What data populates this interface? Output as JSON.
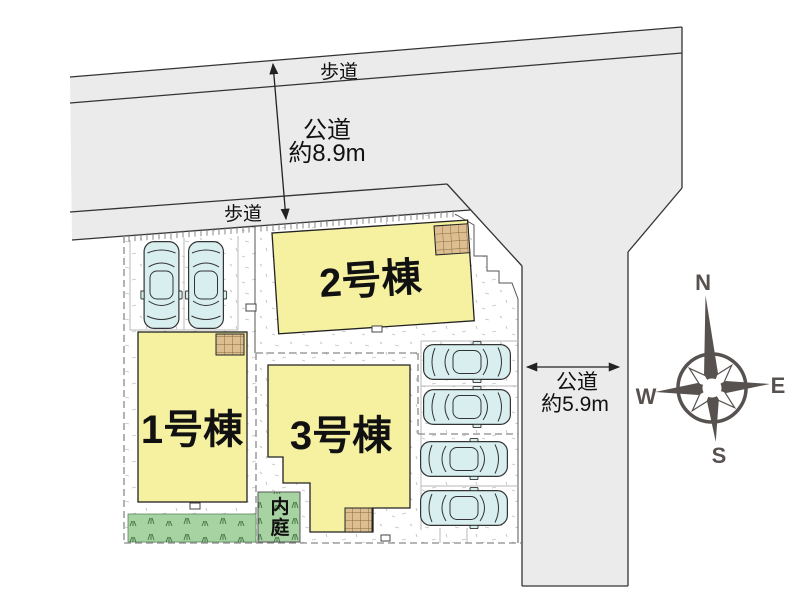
{
  "roads": {
    "top_road": {
      "sidewalk_top_label": "歩道",
      "sidewalk_bottom_label": "歩道",
      "type_label": "公道",
      "width_label": "約8.9m"
    },
    "right_road": {
      "type_label": "公道",
      "width_label": "約5.9m"
    }
  },
  "buildings": [
    {
      "label": "1号棟"
    },
    {
      "label": "2号棟"
    },
    {
      "label": "3号棟"
    }
  ],
  "inner_garden": {
    "label": "内庭",
    "chars": [
      "内",
      "庭"
    ]
  },
  "compass": {
    "north": "N",
    "east": "E",
    "south": "S",
    "west": "W"
  },
  "parking": {
    "spaces_left": 2,
    "spaces_right": 4
  },
  "colors": {
    "road_fill": "#ebebeb",
    "building_fill": "#f5f1a1",
    "car_fill": "#d9efef",
    "green_fill": "#a7d2a2",
    "hatch_fill": "#dcbe90",
    "compass_color": "#575250",
    "line_color": "#333333",
    "text_color": "#111111"
  }
}
